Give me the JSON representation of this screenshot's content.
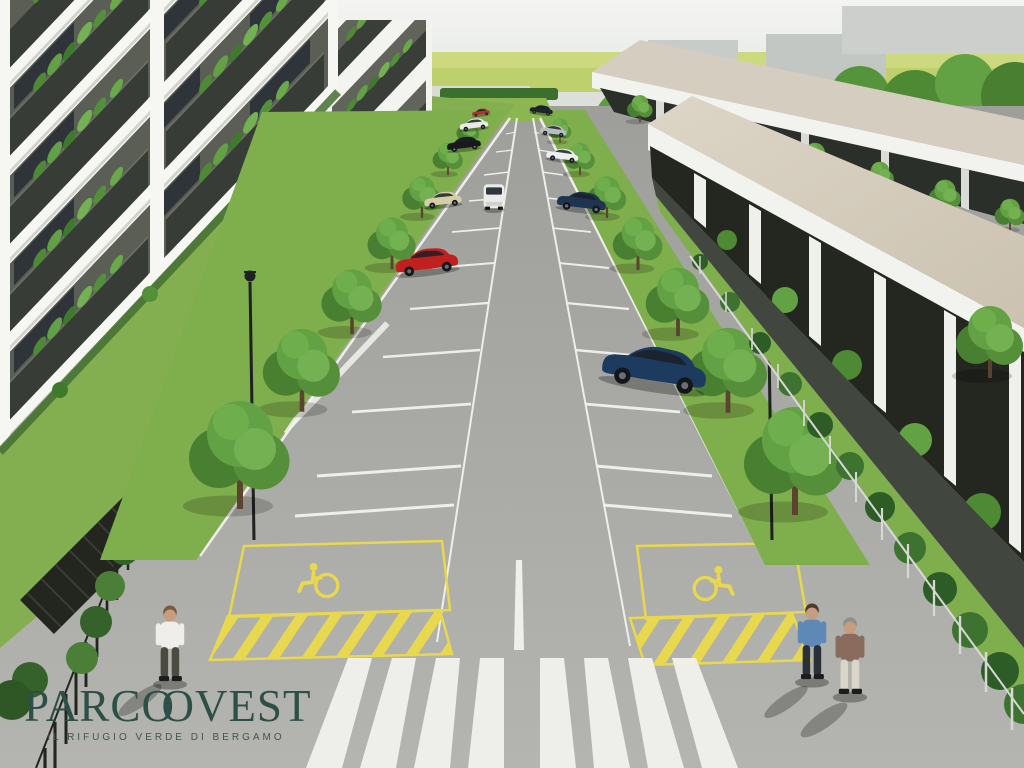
{
  "project": {
    "name": "Parco Ovest",
    "type": "architectural aerial rendering",
    "scene": "residential complex with a central tree-lined parking avenue"
  },
  "logo": {
    "prefix": "PARC",
    "o1": "O",
    "o2": "O",
    "suffix": "VEST",
    "full_text": "PARCOOVEST",
    "tagline": "IL RIFUGIO VERDE DI BERGAMO",
    "color": "#2d4f47"
  },
  "palette": {
    "sky": "#eef0ed",
    "field_green": "#bdd06b",
    "tree_dark": "#497f31",
    "tree_mid": "#5f9c40",
    "tree_light": "#74b152",
    "lawn": "#83af50",
    "asphalt": "#a8a8a4",
    "marking_white": "#f4f4f1",
    "marking_yellow": "#e8d84f",
    "facade_white": "#f6f6f3",
    "balcony_dark": "#383c37",
    "roof_beige": "#d6cdbe",
    "fence_dark": "#23261f",
    "logo_green": "#2d4f47"
  },
  "scene": {
    "left_buildings": {
      "label": "white apartment blocks",
      "floors_visible": 5,
      "balconies": "dark planters full of greenery"
    },
    "right_buildings": {
      "label": "two rows of terraced houses",
      "roof_color": "#d6cdbe",
      "facade": "dark glass with white piers and shrubs"
    },
    "parking": {
      "stall_rows": 2,
      "lane": "central driving lane",
      "disabled_stalls": 2,
      "markings": [
        "white stall lines",
        "yellow disabled-stall boxes",
        "yellow hatched zones",
        "wheelchair symbols",
        "zebra crosswalk",
        "white center line"
      ]
    },
    "vehicles": [
      {
        "type": "hatchback",
        "color": "#c0201e",
        "position": "left row, middle"
      },
      {
        "type": "hatchback",
        "color": "#d6cda9",
        "position": "left row, upper"
      },
      {
        "type": "sedan",
        "color": "#17191c",
        "position": "left row, far"
      },
      {
        "type": "city car",
        "color": "#e9e9e6",
        "position": "left row, far"
      },
      {
        "type": "city car",
        "color": "#b23131",
        "position": "left row, farthest"
      },
      {
        "type": "van",
        "color": "#ededea",
        "position": "driving lane, moving"
      },
      {
        "type": "sedan",
        "color": "#20242b",
        "position": "right row, farthest"
      },
      {
        "type": "city car",
        "color": "#b9bdc1",
        "position": "right row, far"
      },
      {
        "type": "city car",
        "color": "#eceef0",
        "position": "right row, far"
      },
      {
        "type": "sedan",
        "color": "#1f3450",
        "position": "right row, upper"
      },
      {
        "type": "station wagon",
        "color": "#1d3a5f",
        "position": "right row, near"
      }
    ],
    "pedestrians": [
      {
        "outfit": "white shirt, dark trousers",
        "position": "lower left, crossing"
      },
      {
        "outfit": "blue shirt, dark trousers",
        "position": "lower right, walking"
      },
      {
        "outfit": "brown jacket, white trousers",
        "position": "lower right, walking"
      }
    ],
    "landscape": {
      "street_trees": 14,
      "street_lamps": 2,
      "fences": "metal railings with hedges on both sides",
      "background": "green fields, tree line and grey industrial buildings"
    }
  }
}
